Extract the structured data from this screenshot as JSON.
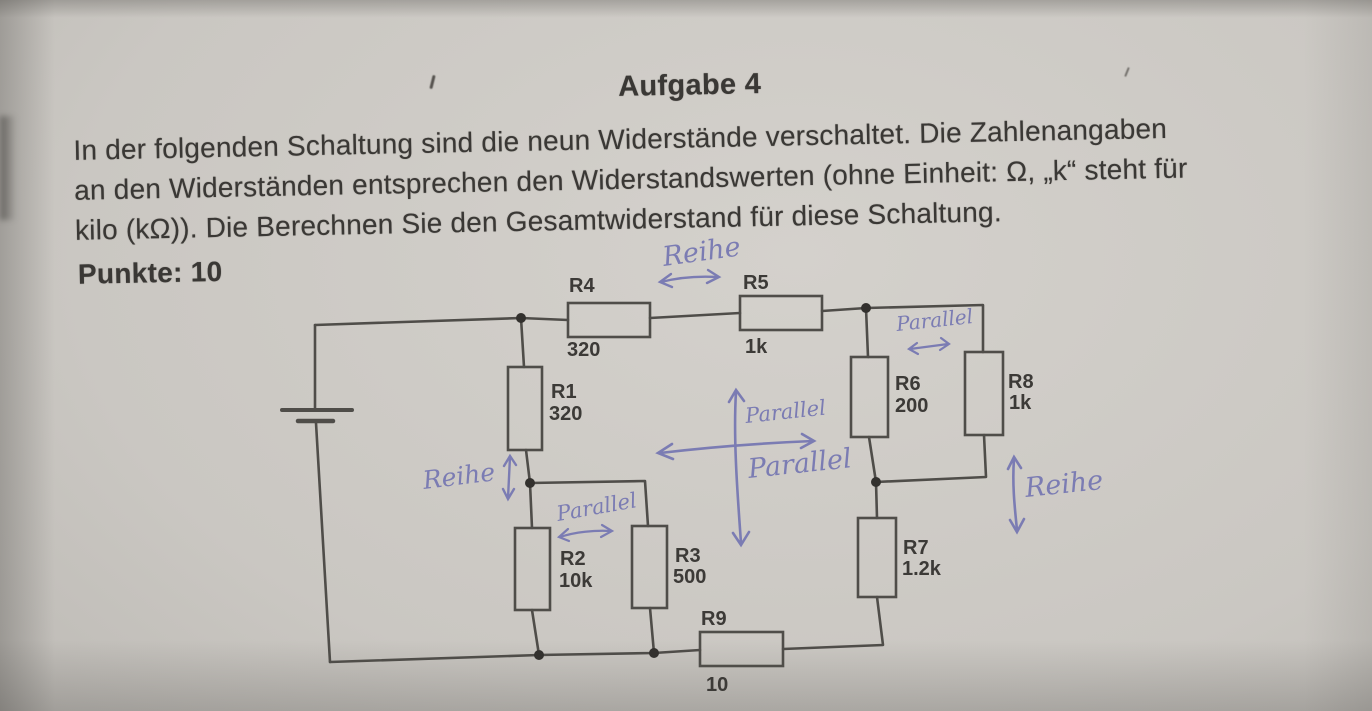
{
  "header": {
    "title": "Aufgabe 4",
    "line1": "In der folgenden Schaltung sind die neun Widerstände verschaltet. Die Zahlenangaben",
    "line2": "an den Widerständen entsprechen den Widerstandswerten (ohne Einheit: Ω, „k“ steht für",
    "line3": "kilo (kΩ)). Die Berechnen Sie den Gesamtwiderstand für diese Schaltung.",
    "points": "Punkte: 10"
  },
  "circuit": {
    "resistors": [
      {
        "name": "R1",
        "value": "320"
      },
      {
        "name": "R2",
        "value": "10k"
      },
      {
        "name": "R3",
        "value": "500"
      },
      {
        "name": "R4",
        "value": "320"
      },
      {
        "name": "R5",
        "value": "1k"
      },
      {
        "name": "R6",
        "value": "200"
      },
      {
        "name": "R7",
        "value": "1.2k"
      },
      {
        "name": "R8",
        "value": "1k"
      },
      {
        "name": "R9",
        "value": "10"
      }
    ],
    "annotations": {
      "reihe_top": "Reihe",
      "parallel_top_right": "Parallel",
      "reihe_left": "Reihe",
      "parallel_mid_left": "Parallel",
      "parallel_center_up": "Parallel",
      "parallel_center": "Parallel",
      "reihe_right": "Reihe"
    }
  },
  "colors": {
    "paper": "#cac7c2",
    "pencil_line": "#4f4d49",
    "printed_text": "#3a3835",
    "handwriting_ink": "#7b7cb3"
  }
}
